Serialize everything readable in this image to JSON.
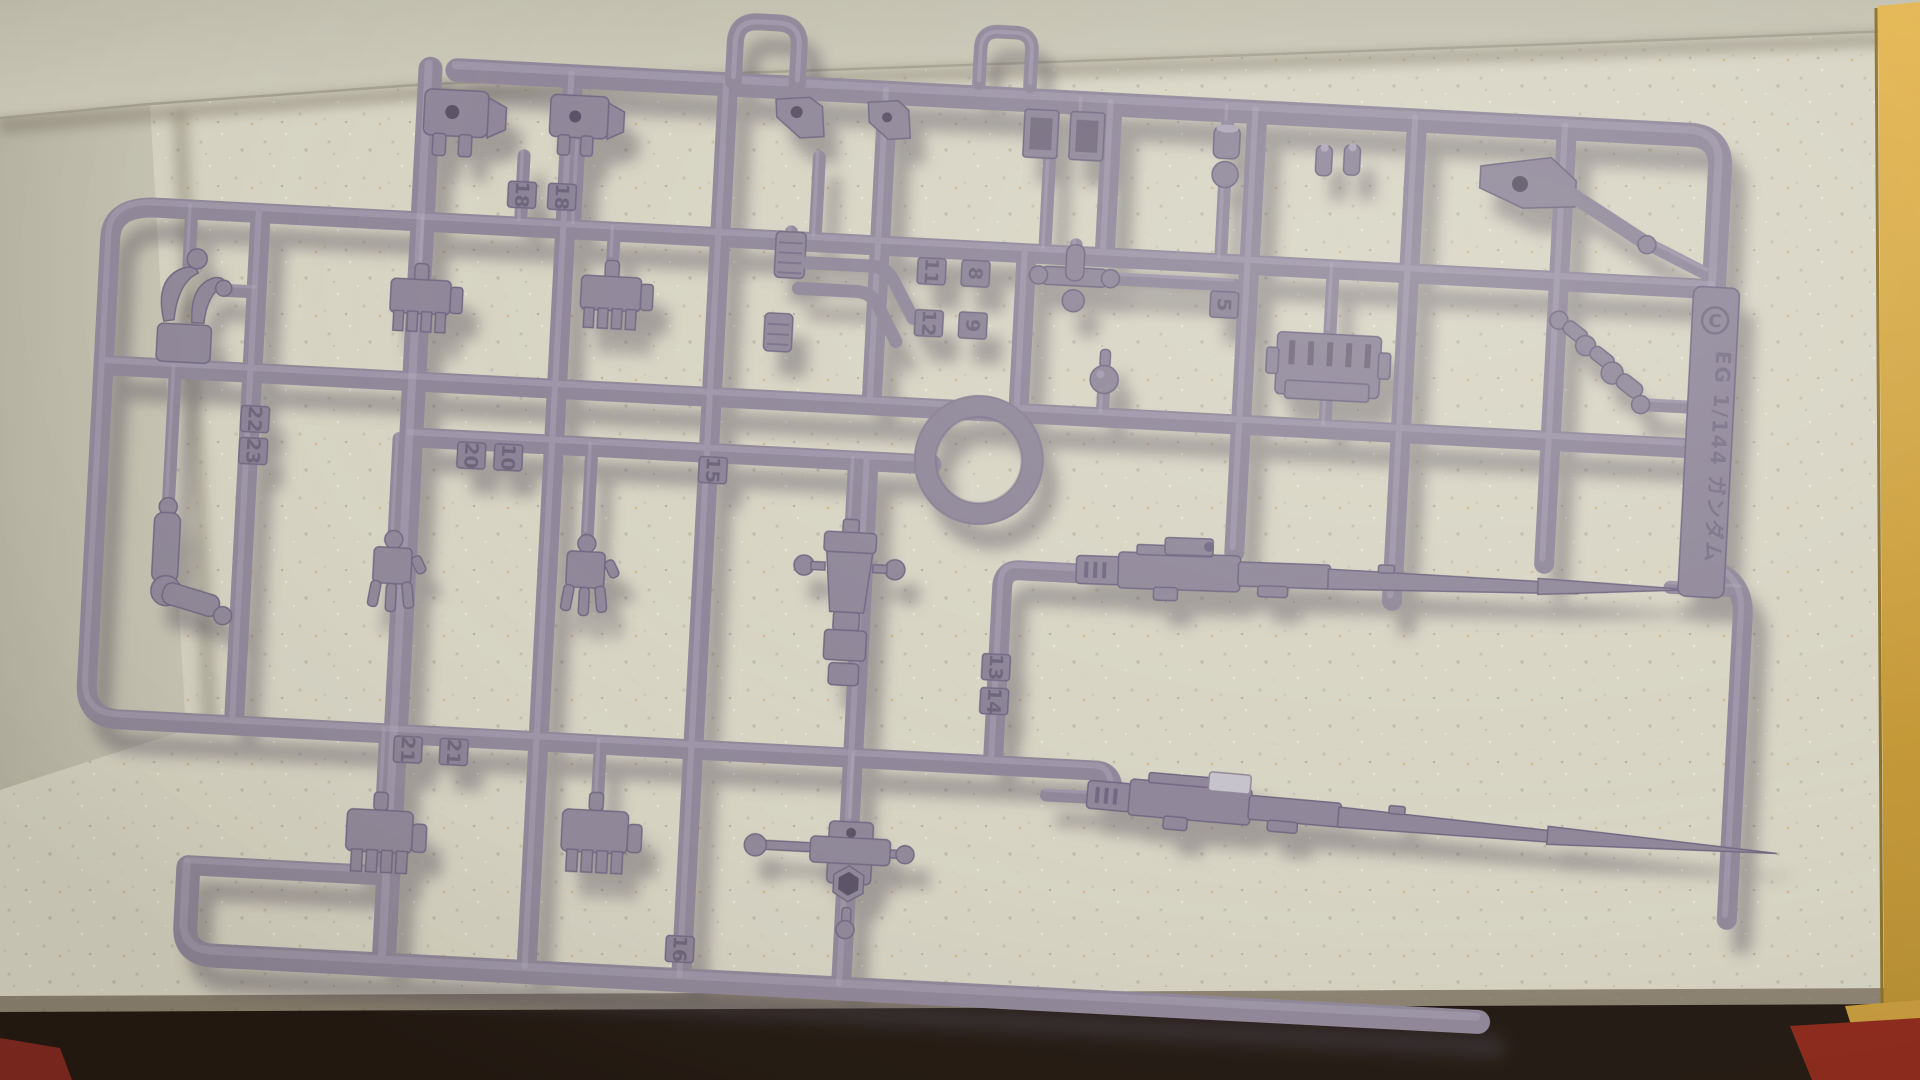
{
  "sprue": {
    "runner_letter": "C",
    "embossed_label": "EG 1/144 ガンダム",
    "plastic_color": "#8e8698",
    "part_tags": [
      {
        "label": "18",
        "x": 505,
        "y": 185
      },
      {
        "label": "18",
        "x": 545,
        "y": 185
      },
      {
        "label": "22",
        "x": 250,
        "y": 423
      },
      {
        "label": "23",
        "x": 250,
        "y": 455
      },
      {
        "label": "20",
        "x": 468,
        "y": 448
      },
      {
        "label": "10",
        "x": 505,
        "y": 448
      },
      {
        "label": "15",
        "x": 710,
        "y": 450
      },
      {
        "label": "11",
        "x": 918,
        "y": 240
      },
      {
        "label": "8",
        "x": 962,
        "y": 240
      },
      {
        "label": "12",
        "x": 918,
        "y": 292
      },
      {
        "label": "9",
        "x": 962,
        "y": 292
      },
      {
        "label": "5",
        "x": 1212,
        "y": 258
      },
      {
        "label": "21",
        "x": 420,
        "y": 745
      },
      {
        "label": "21",
        "x": 466,
        "y": 745
      },
      {
        "label": "13",
        "x": 1003,
        "y": 632
      },
      {
        "label": "14",
        "x": 1003,
        "y": 666
      },
      {
        "label": "16",
        "x": 702,
        "y": 930
      }
    ]
  },
  "box": {
    "floor_color": "#d7d4c3",
    "wall_color": "#c6c3b2",
    "shadow_strip_color": "#1d130c",
    "accent_yellow": "#d3a23c",
    "accent_red": "#8c2415"
  }
}
